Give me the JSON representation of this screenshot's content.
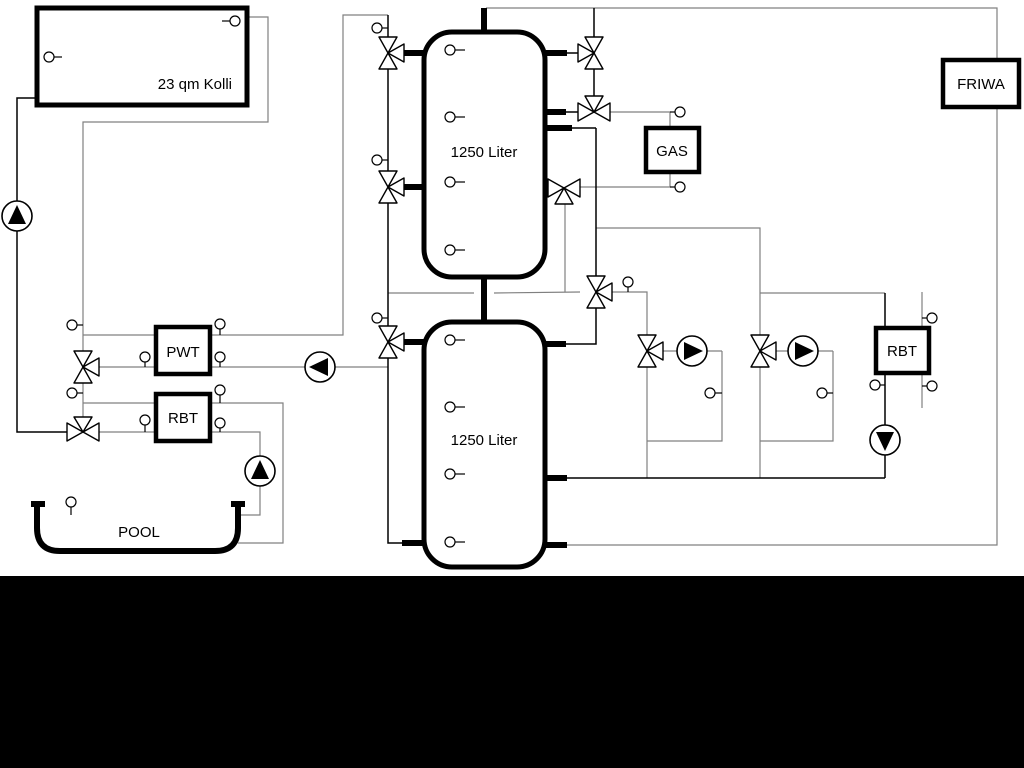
{
  "diagram": {
    "collector": {
      "label": "23 qm Kolli"
    },
    "buffer_tank_top": {
      "label": "1250 Liter"
    },
    "buffer_tank_bottom": {
      "label": "1250 Liter"
    },
    "gas_boiler": {
      "label": "GAS"
    },
    "friwa": {
      "label": "FRIWA"
    },
    "pwt": {
      "label": "PWT"
    },
    "rbt_left": {
      "label": "RBT"
    },
    "rbt_right": {
      "label": "RBT"
    },
    "pool": {
      "label": "POOL"
    }
  },
  "colors": {
    "background": "#ffffff",
    "pipe_gray": "#808080",
    "pipe_black": "#000000",
    "bottom_bar": "#000000"
  }
}
